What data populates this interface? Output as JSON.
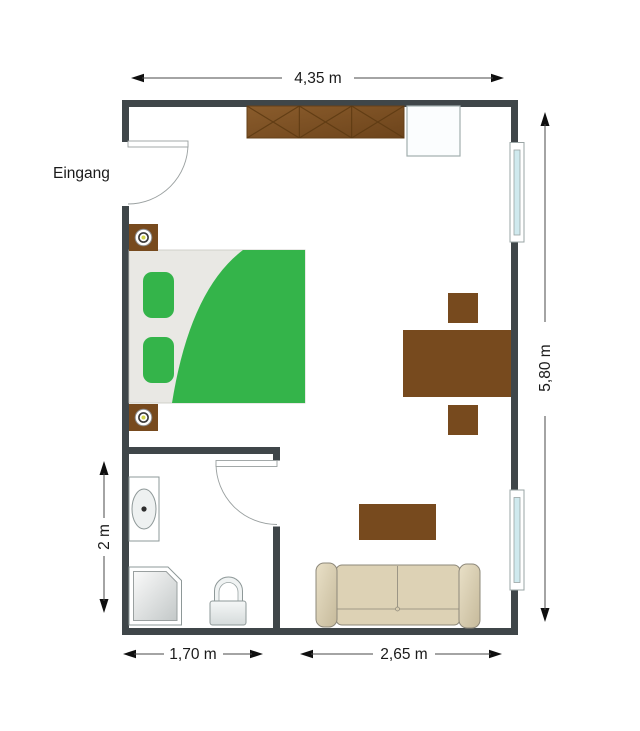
{
  "labels": {
    "entrance": "Eingang"
  },
  "dimensions": {
    "top_width": "4,35 m",
    "right_height": "5,80 m",
    "bath_height": "2 m",
    "bath_width": "1,70 m",
    "living_width": "2,65 m"
  },
  "plan": {
    "type": "floor-plan",
    "rooms": [
      "main room",
      "bathroom"
    ],
    "items": [
      "entrance door",
      "wardrobe",
      "cabinet",
      "double bed",
      "nightstand with lamp",
      "nightstand with lamp",
      "dining table",
      "chair",
      "chair",
      "window",
      "window",
      "coffee table",
      "sofa",
      "bathroom door",
      "sink",
      "shower",
      "toilet"
    ]
  },
  "colors": {
    "wall": "#3f4649",
    "wood": "#774a1e",
    "wood-dark": "#5d3a12",
    "green": "#34b44a",
    "mattress": "#e9e8e4",
    "sofa": "#ddd2b5",
    "sofa-line": "#8d887a",
    "glass": "#cfe9ee",
    "fixture-line": "#8e9898",
    "text": "#1a1a1a"
  }
}
